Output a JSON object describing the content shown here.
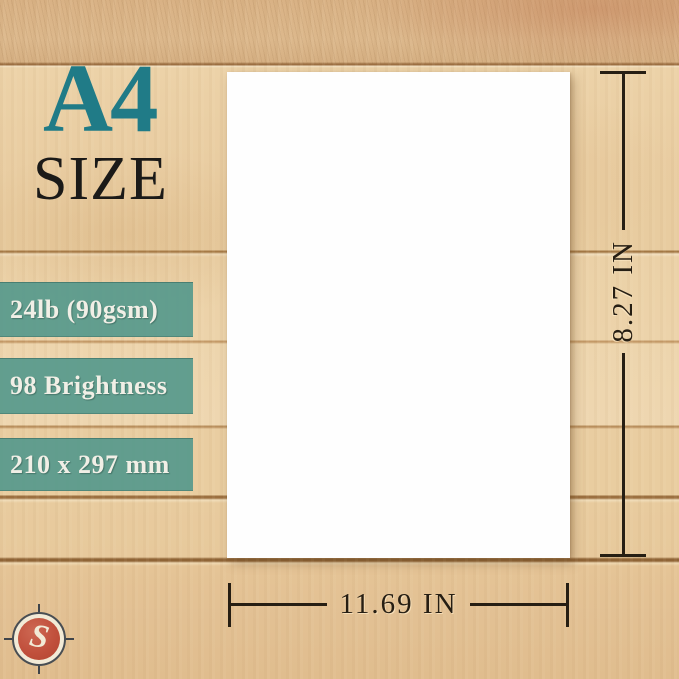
{
  "header": {
    "title_main": "A4",
    "title_sub": "SIZE"
  },
  "specs": {
    "items": [
      "24lb (90gsm)",
      "98 Brightness",
      "210 x 297 mm"
    ]
  },
  "dimensions": {
    "height_label": "8.27 IN",
    "width_label": "11.69 IN"
  },
  "logo": {
    "monogram": "S"
  },
  "colors": {
    "accent_teal": "#207b87",
    "banner_teal": "#569a8d",
    "ink": "#261e13",
    "paper_white": "#fefefe",
    "logo_red": "#c1503c"
  }
}
